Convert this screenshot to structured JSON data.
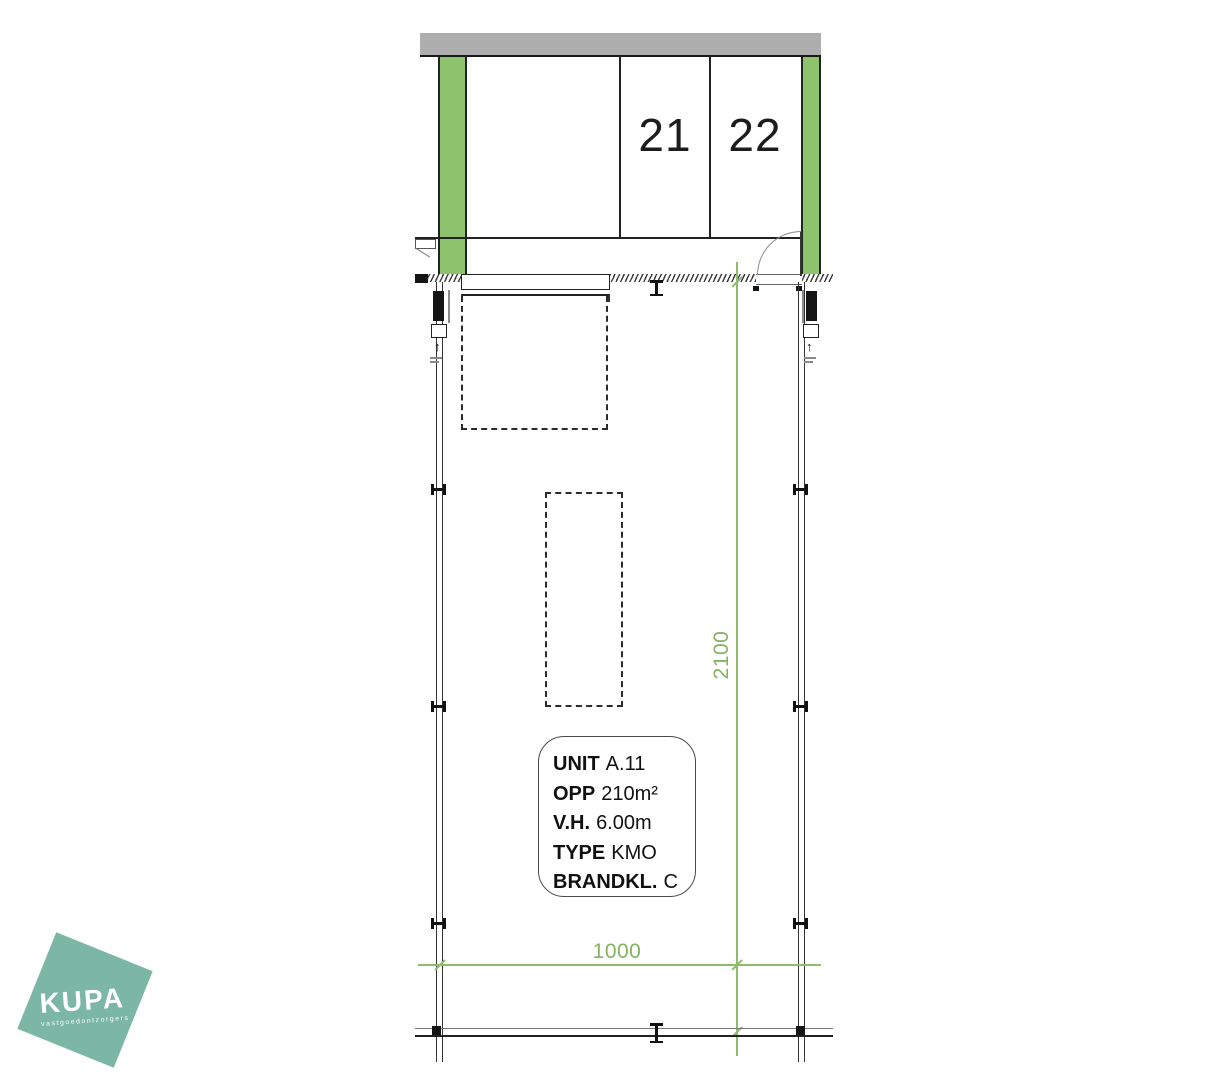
{
  "colors": {
    "strip_green": "#8CC36C",
    "dimension_green": "#8FBC6B",
    "roadway_gray": "#AEAEAE",
    "logo_teal": "#7CB7A5"
  },
  "parking": {
    "spaces": [
      {
        "label": "21"
      },
      {
        "label": "22"
      }
    ]
  },
  "dimensions": {
    "vertical": "2100",
    "horizontal": "1000"
  },
  "unit_info": {
    "lines": [
      {
        "label": "UNIT",
        "value": "A.11"
      },
      {
        "label": "OPP",
        "value": "210m²"
      },
      {
        "label": "V.H.",
        "value": "6.00m"
      },
      {
        "label": "TYPE",
        "value": "KMO"
      },
      {
        "label": "BRANDKL.",
        "value": "C"
      }
    ]
  },
  "logo": {
    "brand": "KUPA",
    "tagline": "vastgoedontzorgers"
  }
}
